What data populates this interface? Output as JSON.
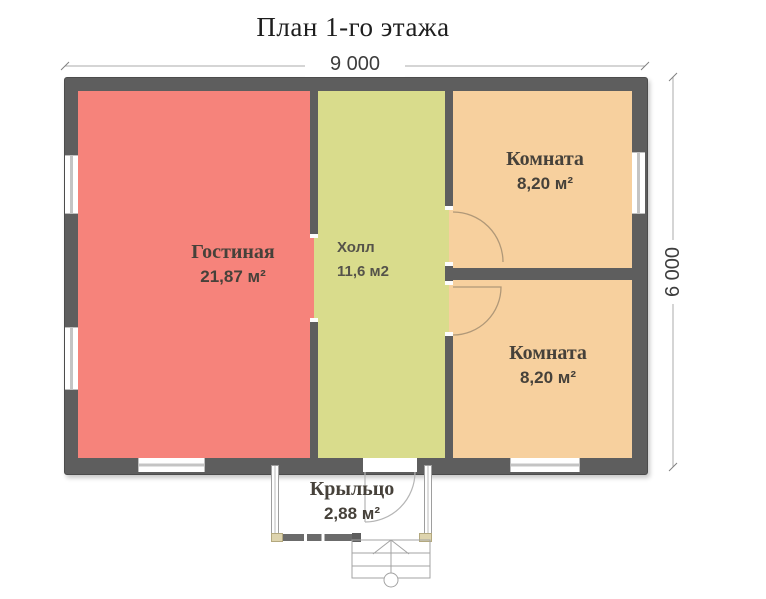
{
  "title": "План 1-го этажа",
  "dimensions": {
    "width": "9 000",
    "height": "6 000"
  },
  "rooms": {
    "living": {
      "name": "Гостиная",
      "area": "21,87 м²"
    },
    "hall": {
      "name": "Холл",
      "area": "11,6 м2"
    },
    "room_top": {
      "name": "Комната",
      "area": "8,20 м²"
    },
    "room_bottom": {
      "name": "Комната",
      "area": "8,20 м²"
    },
    "porch": {
      "name": "Крыльцо",
      "area": "2,88 м²"
    }
  },
  "colors": {
    "living": "#f6837b",
    "hall": "#d9dc8c",
    "room": "#f7d09e",
    "wall": "#5e5e5e",
    "text": "#46413a"
  }
}
